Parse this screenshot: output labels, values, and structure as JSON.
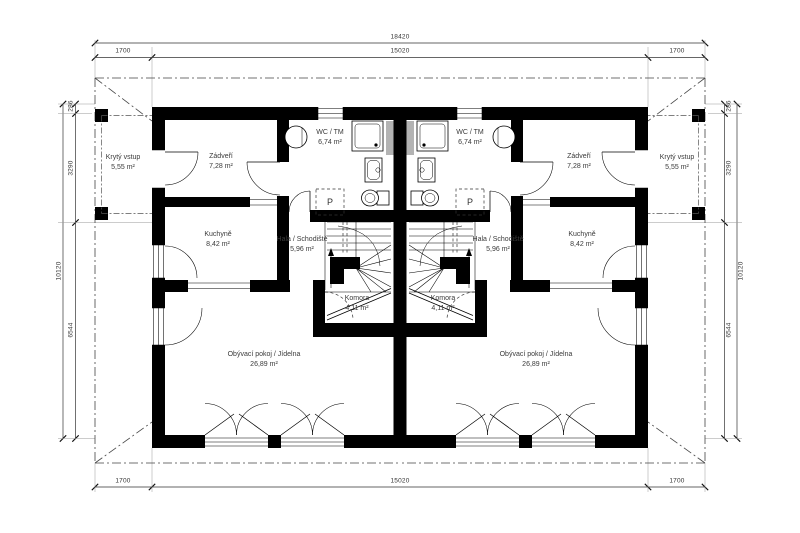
{
  "plan": {
    "drawing_type": "Ground floor plan - semi-detached (mirrored twin) house",
    "dimensions": {
      "top_total": "18420",
      "top_segments": [
        "1700",
        "15020",
        "1700"
      ],
      "bottom_segments": [
        "1700",
        "15020",
        "1700"
      ],
      "side_total": "10120",
      "side_segments": [
        "286",
        "3290",
        "6544"
      ]
    },
    "units": {
      "left": {
        "washer_label": "P",
        "rooms": [
          {
            "name": "Zádveří",
            "area": "7,28 m²"
          },
          {
            "name": "WC / TM",
            "area": "6,74 m²"
          },
          {
            "name": "Kuchyně",
            "area": "8,42 m²"
          },
          {
            "name": "Hala / Schodiště",
            "area": "5,96 m²"
          },
          {
            "name": "Komora",
            "area": "4,11 m²"
          },
          {
            "name": "Obývací pokoj / Jídelna",
            "area": "26,89 m²"
          },
          {
            "name": "Krytý vstup",
            "area": "5,55 m²"
          }
        ]
      },
      "right": {
        "washer_label": "P",
        "rooms": [
          {
            "name": "Zádveří",
            "area": "7,28 m²"
          },
          {
            "name": "WC / TM",
            "area": "6,74 m²"
          },
          {
            "name": "Kuchyně",
            "area": "8,42 m²"
          },
          {
            "name": "Hala / Schodiště",
            "area": "5,96 m²"
          },
          {
            "name": "Komora",
            "area": "4,11 m²"
          },
          {
            "name": "Obývací pokoj / Jídelna",
            "area": "26,89 m²"
          },
          {
            "name": "Krytý vstup",
            "area": "5,55 m²"
          }
        ]
      }
    }
  }
}
